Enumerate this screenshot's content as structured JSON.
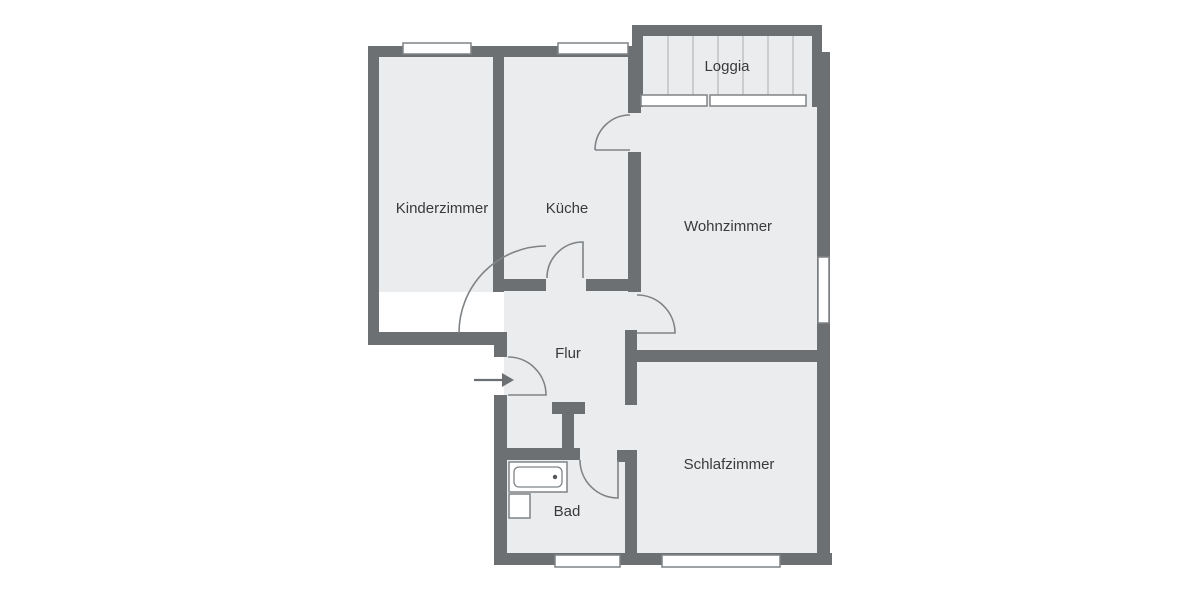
{
  "plan": {
    "type": "apartment-floor-plan",
    "language": "de"
  },
  "rooms": [
    {
      "id": "kinderzimmer",
      "label": "Kinderzimmer"
    },
    {
      "id": "kueche",
      "label": "Küche"
    },
    {
      "id": "wohnzimmer",
      "label": "Wohnzimmer"
    },
    {
      "id": "loggia",
      "label": "Loggia"
    },
    {
      "id": "flur",
      "label": "Flur"
    },
    {
      "id": "bad",
      "label": "Bad"
    },
    {
      "id": "schlafzimmer",
      "label": "Schlafzimmer"
    }
  ],
  "icons": {
    "entry_arrow_icon": "→",
    "bathtub_icon": "bathtub",
    "washbasin_icon": "washbasin"
  },
  "colors": {
    "wall": "#6d7073",
    "room_fill": "#ebeced",
    "line": "#7f8386",
    "deck_line": "#a9adb0",
    "text": "#3a3a3c",
    "background": "#ffffff"
  }
}
